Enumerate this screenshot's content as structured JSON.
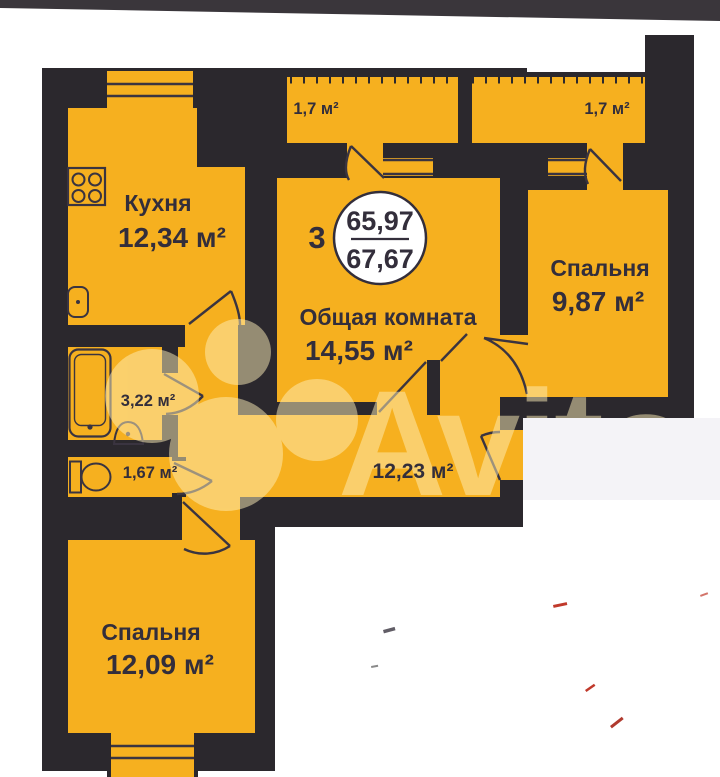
{
  "floor_plan": {
    "unit_summary": {
      "rooms_count": "3",
      "living_area": "65,97",
      "total_area": "67,67"
    },
    "rooms": {
      "kitchen": {
        "label": "Кухня",
        "area": "12,34 м²"
      },
      "bedroom_right": {
        "label": "Спальня",
        "area": "9,87 м²"
      },
      "living_room": {
        "label": "Общая комната",
        "area": "14,55 м²"
      },
      "bedroom_bottom": {
        "label": "Спальня",
        "area": "12,09 м²"
      },
      "bathroom": {
        "area": "3,22 м²"
      },
      "toilet": {
        "area": "1,67 м²"
      },
      "hallway": {
        "area": "12,23 м²"
      },
      "balcony_left": {
        "area": "1,7 м²"
      },
      "balcony_right": {
        "area": "1,7 м²"
      }
    },
    "watermark": {
      "text": "Avito"
    },
    "colors": {
      "room_fill": "#F6B01F",
      "wall": "#2B282D",
      "label_text": "#332E3B",
      "watermark_tint": "#FFEFB9",
      "badge_fill": "#FFFFFF"
    }
  }
}
